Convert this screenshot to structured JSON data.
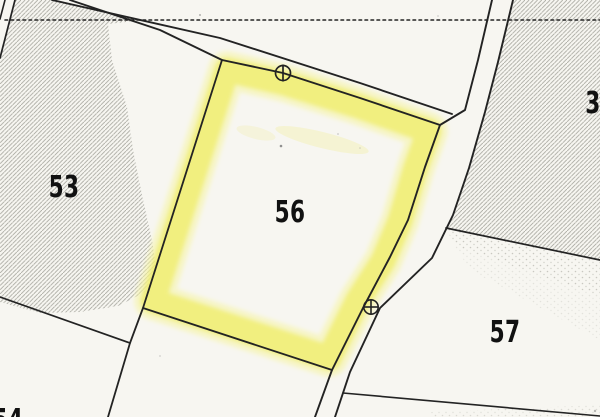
{
  "map": {
    "kind": "cadastral-parcel-map",
    "highlighted_parcel": "56"
  },
  "parcels": [
    {
      "label": "53",
      "highlighted": false
    },
    {
      "label": "56",
      "highlighted": true
    },
    {
      "label": "57",
      "highlighted": false
    },
    {
      "label": "3",
      "highlighted": false
    },
    {
      "label": "54",
      "highlighted": false
    }
  ],
  "markers": [
    {
      "name": "boundary-point-circle-marker",
      "description": "circle with vertical bar on road edge"
    },
    {
      "name": "benchmark-circle-cross-marker",
      "description": "circle with cross on road"
    }
  ],
  "colors": {
    "background": "#f7f6f1",
    "line": "#232323",
    "highlight": "#f0ed6a",
    "highlight_soft": "#f6f4a6",
    "hatch": "#8f8f85",
    "label": "#111111"
  }
}
